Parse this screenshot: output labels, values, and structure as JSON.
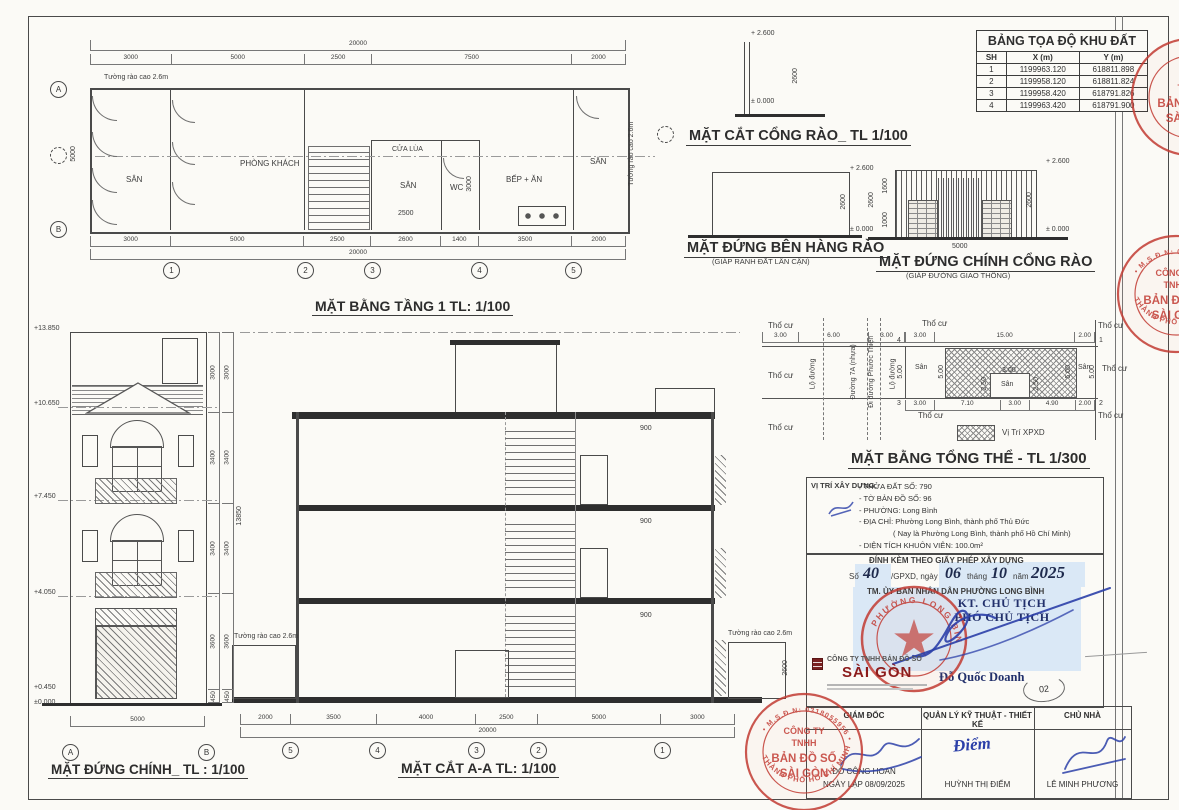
{
  "labels": {
    "fence": "Tường rào cao 2.6m"
  },
  "coord_table": {
    "title": "BẢNG TỌA ĐỘ KHU ĐẤT",
    "headers": [
      "SH",
      "X (m)",
      "Y (m)"
    ],
    "rows": [
      [
        "1",
        "1199963.120",
        "618811.898"
      ],
      [
        "2",
        "1199958.120",
        "618811.824"
      ],
      [
        "3",
        "1199958.420",
        "618791.826"
      ],
      [
        "4",
        "1199963.420",
        "618791.900"
      ]
    ]
  },
  "floor_plan": {
    "title": "MẶT BẰNG TẦNG 1 TL: 1/100",
    "totals": [
      "20000"
    ],
    "dims_top": [
      "3000",
      "5000",
      "2500",
      "7500",
      "2000"
    ],
    "dims_bottom": [
      "3000",
      "5000",
      "2500",
      "2600",
      "1400",
      "3500",
      "2000"
    ],
    "dim_left": "5000",
    "dim_inner": "3000",
    "dim_small": "2500",
    "rooms": {
      "san_left": "SÂN",
      "living": "PHÒNG KHÁCH",
      "cua_lua": "CỬA LÙA",
      "san_mid": "SÂN",
      "wc": "WC",
      "kitchen": "BẾP + ĂN",
      "san_right": "SÂN"
    },
    "grid_cols": [
      "1",
      "2",
      "3",
      "4",
      "5"
    ],
    "grid_a": "A",
    "grid_b": "B"
  },
  "gate_section": {
    "title": "MẶT CẮT CỔNG RÀO_ TL 1/100",
    "level_top": "+ 2.600",
    "level_zero": "± 0.000",
    "dim": "2600"
  },
  "side_fence": {
    "title": "MẶT ĐỨNG BÊN HÀNG RÀO",
    "subtitle": "(GIÁP RANH ĐẤT LÂN CẬN)",
    "level_top": "+ 2.600",
    "level_zero": "± 0.000",
    "dim": "2600"
  },
  "gate_front": {
    "title": "MẶT ĐỨNG CHÍNH CỔNG RÀO",
    "subtitle": "(GIÁP ĐƯỜNG GIAO THÔNG)",
    "level_top": "+ 2.600",
    "level_zero": "± 0.000",
    "dim_left": "2600",
    "dim_right": "2600",
    "dim_upper": "1600",
    "dim_lower": "1000",
    "width": "5000"
  },
  "site_plan": {
    "title": "MẶT BẰNG TỔNG THỂ - TL 1/300",
    "tho_cu": "Thổ cư",
    "san": "Sân",
    "road_dims": [
      "3.00",
      "6.00",
      "3.00"
    ],
    "road_label_1": "Lộ đường",
    "road_label_2": "Đường 7A (nhựa)",
    "road_label_2b": "Đi đường Phước Thiện",
    "road_label_3": "Lộ đường",
    "plot_dims_top": [
      "3.00",
      "15.00",
      "2.00"
    ],
    "plot_dims_bottom": [
      "3.00",
      "7.10",
      "3.00",
      "4.90",
      "2.00"
    ],
    "dim_v": "5.00",
    "san_w": "3.00",
    "san_h": "2.50",
    "corners": [
      "1",
      "2",
      "3",
      "4"
    ],
    "legend_label": "Vị Trí XPXD"
  },
  "location_box": {
    "heading": "VỊ TRÍ XÂY DỰNG:",
    "lines": [
      "- THỬA ĐẤT SỐ:  790",
      "- TỜ BẢN ĐỒ SỐ: 96",
      "- PHƯỜNG:   Long Bình",
      "- ĐỊA CHỈ:  Phường Long Bình, thành phố Thủ Đức",
      "( Nay là Phường Long Bình, thành phố Hồ Chí Minh)",
      "- DIỆN TÍCH KHUÔN VIÊN: 100.0m²"
    ]
  },
  "permit_box": {
    "line1": "ĐÍNH KÈM THEO GIẤY PHÉP XÂY DỰNG",
    "so_label": "Số",
    "so_value": "40",
    "gpxd_label": "/GPXD, ngày",
    "day": "06",
    "thang": "tháng",
    "month": "10",
    "nam": "năm",
    "year": "2025",
    "line3": "TM. ỦY BAN NHÂN DÂN PHƯỜNG LONG BÌNH"
  },
  "approval": {
    "title1": "KT. CHỦ TỊCH",
    "title2": "PHÓ CHỦ TỊCH",
    "name": "Đỗ Quốc Doanh",
    "page": "02"
  },
  "title_block": {
    "company_line1": "CÔNG TY TNHH BẢN ĐỒ SỐ",
    "company_line2": "SÀI GÒN",
    "col1_header": "GIÁM ĐỐC",
    "col1_name": "ĐỖ CÔNG HOAN",
    "col1_date": "NGÀY LẬP 08/09/2025",
    "col2_header": "QUẢN LÝ KỸ THUẬT - THIẾT KẾ",
    "col2_sig": "Điểm",
    "col2_name": "HUỲNH THỊ ĐIỂM",
    "col3_header": "CHỦ NHÀ",
    "col3_name": "LÊ MINH PHƯƠNG"
  },
  "front_elevation": {
    "title": "MẶT ĐỨNG CHÍNH_ TL : 1/100",
    "levels": [
      "+13.850",
      "+10.650",
      "+7.450",
      "+4.050",
      "+0.450",
      "±0.000"
    ],
    "dims_right": [
      "3000",
      "3400",
      "3400",
      "3600",
      "450"
    ],
    "width": [
      "5000"
    ],
    "grid_a": "A",
    "grid_b": "B"
  },
  "section": {
    "title": "MẶT CẮT A-A TL: 1/100",
    "dims_left": [
      "3000",
      "3400",
      "3400",
      "3600",
      "450"
    ],
    "total_height": "13850",
    "dims_bottom": [
      "2000",
      "3500",
      "4000",
      "2500",
      "5000",
      "3000"
    ],
    "totals": [
      "20000"
    ],
    "grid_cols": [
      "5",
      "4",
      "3",
      "2",
      "1"
    ],
    "balcony_dim": "900",
    "fence_dim": "2600"
  },
  "stamps": {
    "company": {
      "arc_msdn": "• M.S.Đ.N: 0318055956 •",
      "center1": "CÔNG TY",
      "center2": "TNHH",
      "center3": "BẢN ĐỒ SỐ",
      "center4": "SÀI GÒN",
      "arc_bottom": "THÀNH PHỐ HỒ CHÍ MINH"
    },
    "ubnd_arc": "PHƯỜNG LONG BÌNH"
  },
  "colors": {
    "stamp_red": "#c23b33",
    "ink_blue": "#2b3fa8",
    "highlight": "#cfe1f6"
  }
}
